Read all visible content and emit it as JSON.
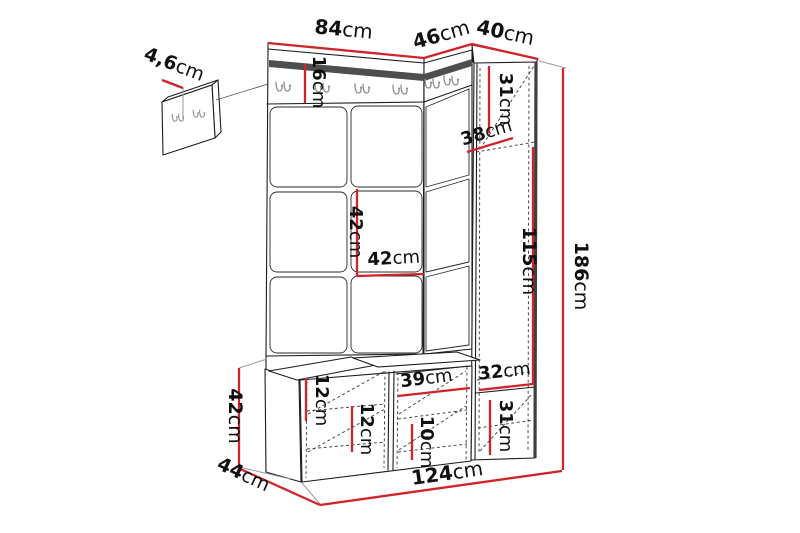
{
  "diagram": {
    "title": "hallway-furniture-dimension-diagram",
    "background_color": "#ffffff",
    "dimension_line_color": "#d1232a",
    "outline_color": "#1c1c1c",
    "hook_color": "#8d8d8d",
    "dimensions": {
      "hook_panel_thickness": {
        "value": "4,6",
        "unit": "cm"
      },
      "panel_width": {
        "value": "84",
        "unit": "cm"
      },
      "corner_width": {
        "value": "46",
        "unit": "cm"
      },
      "cabinet_width": {
        "value": "40",
        "unit": "cm"
      },
      "rail_height": {
        "value": "16",
        "unit": "cm"
      },
      "cabinet_top_height": {
        "value": "31",
        "unit": "cm"
      },
      "cabinet_depth": {
        "value": "38",
        "unit": "cm"
      },
      "cabinet_mid_height": {
        "value": "115",
        "unit": "cm"
      },
      "total_height": {
        "value": "186",
        "unit": "cm"
      },
      "tile_height": {
        "value": "42",
        "unit": "cm"
      },
      "tile_width": {
        "value": "42",
        "unit": "cm"
      },
      "cabinet_bottom_width": {
        "value": "32",
        "unit": "cm"
      },
      "cabinet_bottom_height": {
        "value": "31",
        "unit": "cm"
      },
      "seat_thickness": {
        "value": "12",
        "unit": "cm"
      },
      "bench_shelf_height": {
        "value": "12",
        "unit": "cm"
      },
      "bench_compartment_width": {
        "value": "39",
        "unit": "cm"
      },
      "bench_compartment_height": {
        "value": "10",
        "unit": "cm"
      },
      "bench_height": {
        "value": "42",
        "unit": "cm"
      },
      "bench_depth": {
        "value": "44",
        "unit": "cm"
      },
      "total_width": {
        "value": "124",
        "unit": "cm"
      }
    }
  }
}
